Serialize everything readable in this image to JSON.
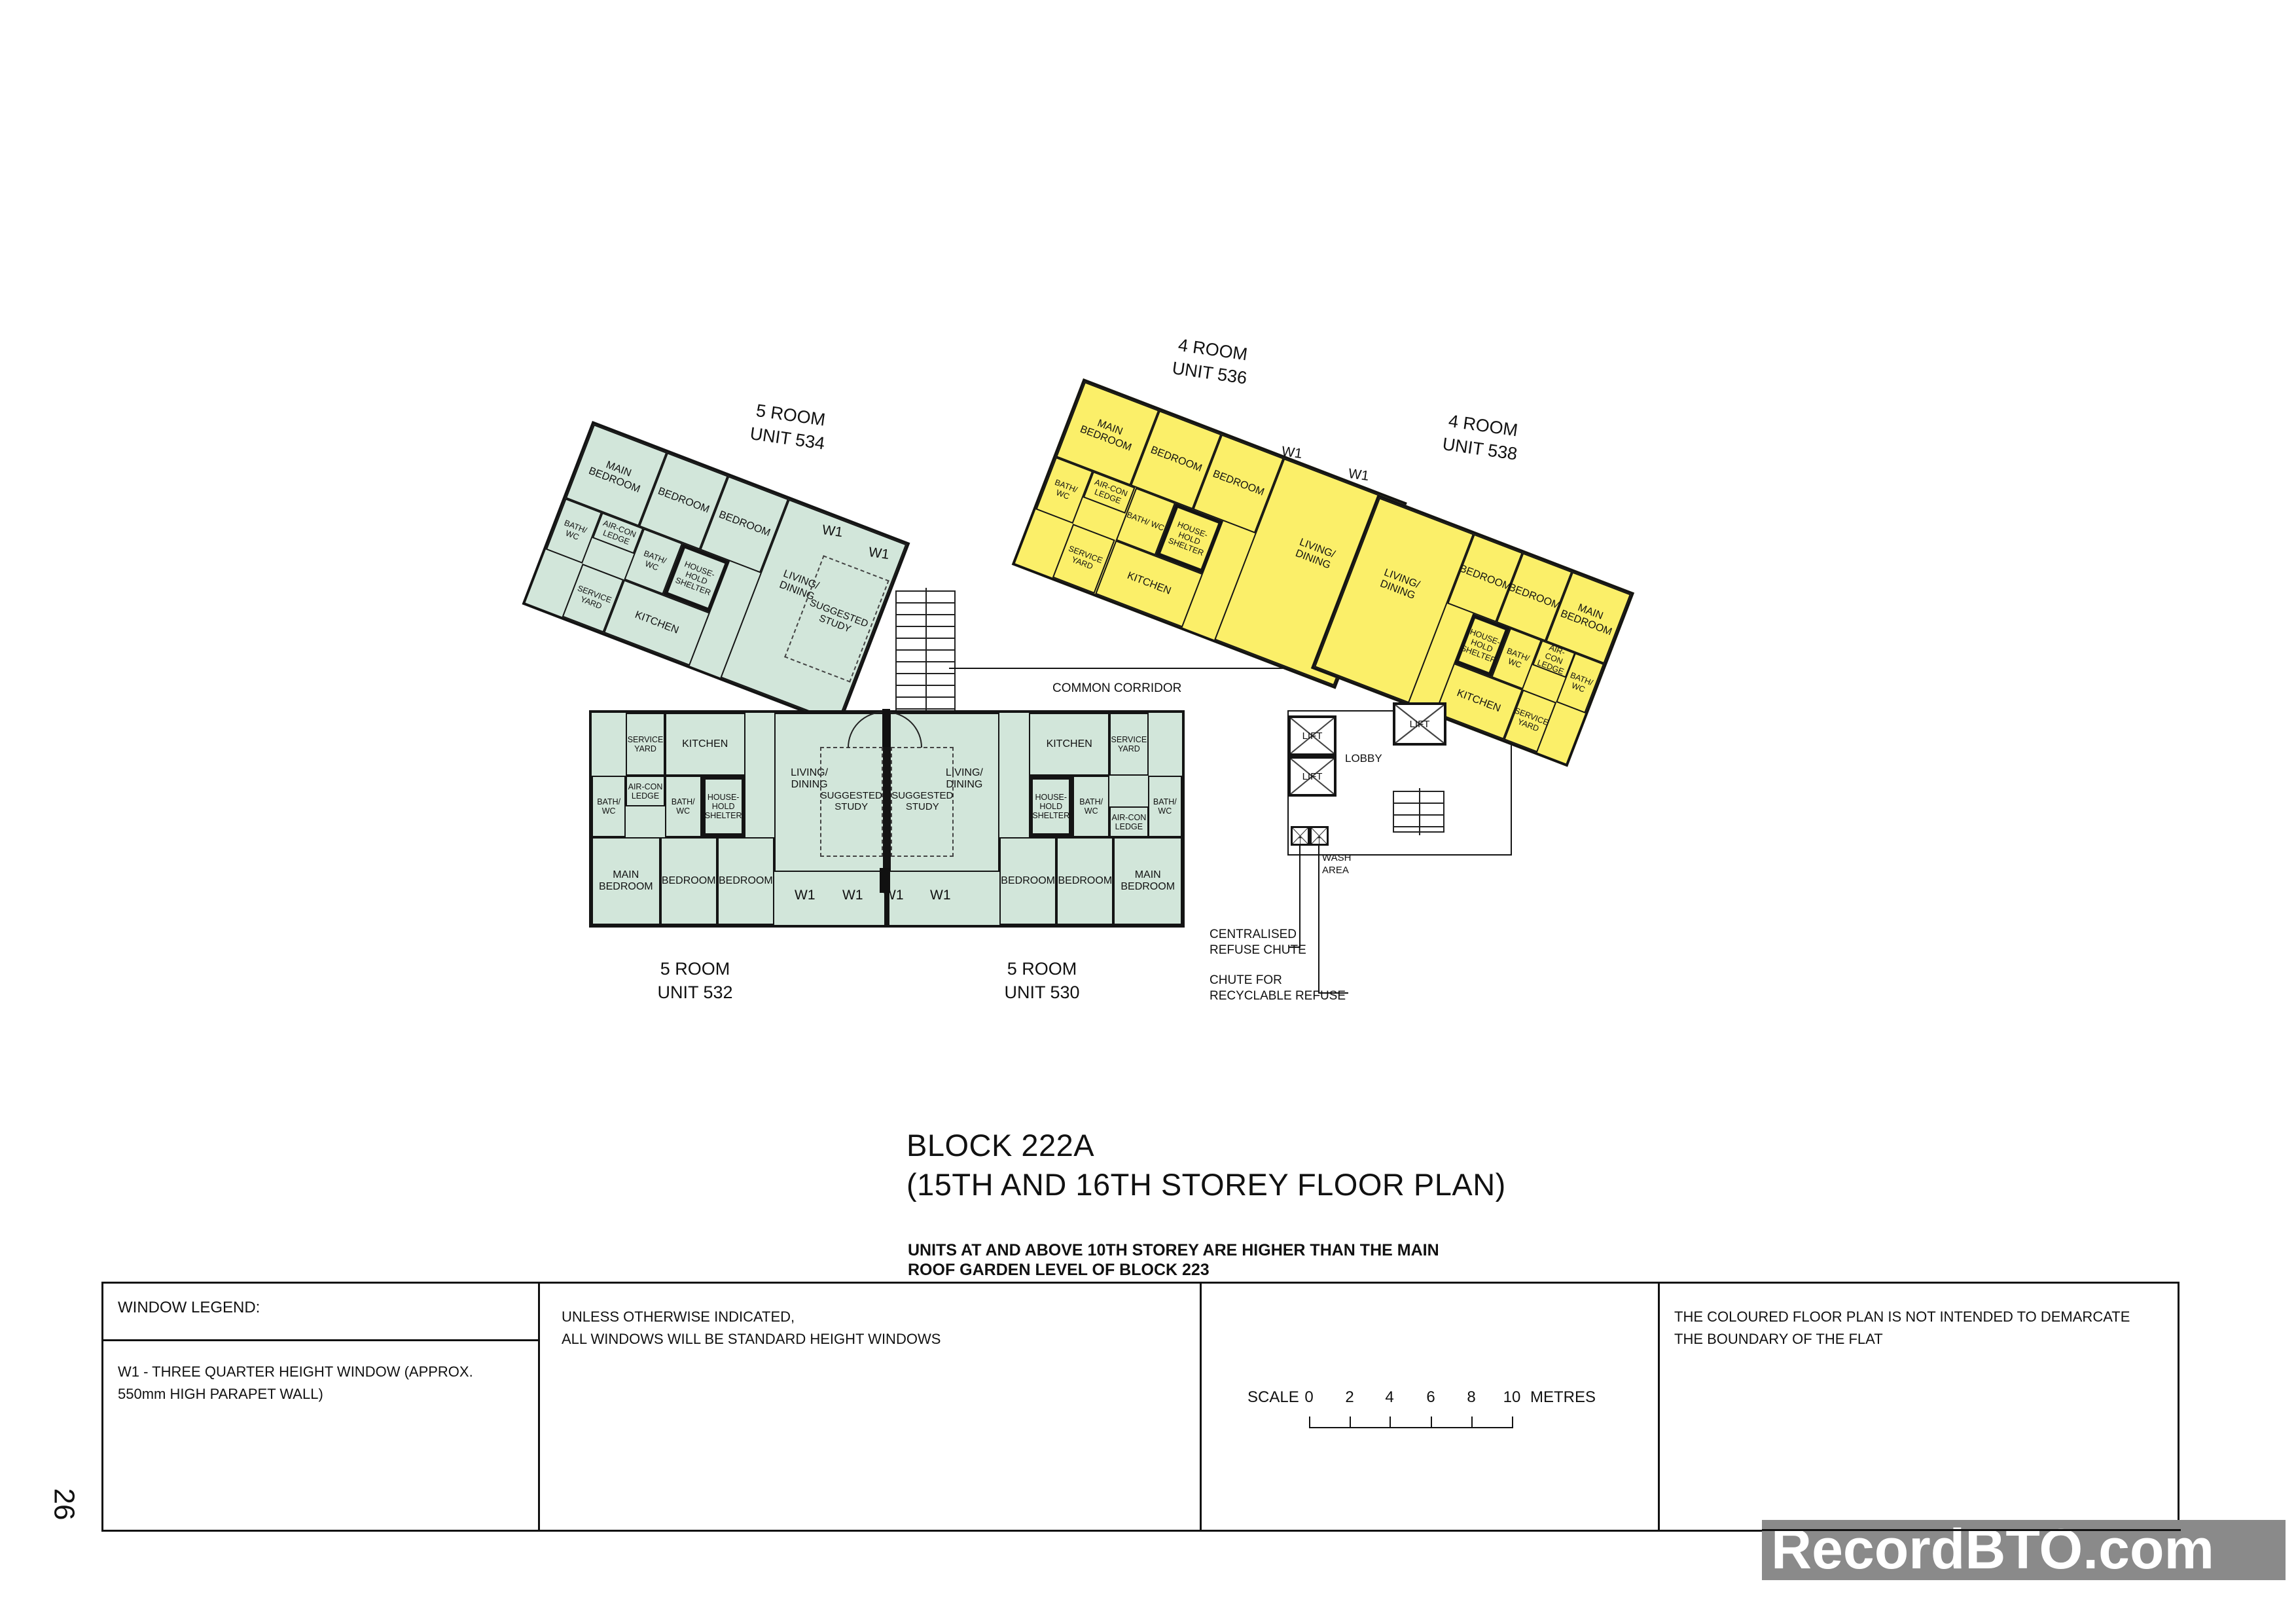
{
  "page_number": "26",
  "watermark": "RecordBTO.com",
  "colors": {
    "five_room_fill": "#d2e6da",
    "four_room_fill": "#fbef69",
    "wall": "#141414",
    "watermark_bg": "#8a8a8a"
  },
  "title": {
    "block": "BLOCK 222A",
    "storey": "(15TH AND 16TH STOREY FLOOR PLAN)",
    "note_line1": "UNITS AT AND ABOVE 10TH STOREY ARE HIGHER THAN THE MAIN",
    "note_line2": "ROOF GARDEN LEVEL OF BLOCK 223"
  },
  "plan": {
    "common_corridor": "COMMON CORRIDOR",
    "lobby": "LOBBY",
    "lift": "LIFT",
    "wash_area": "WASH AREA",
    "w1": "W1",
    "centralised_line1": "CENTRALISED",
    "centralised_line2": "REFUSE CHUTE",
    "recyclable_line1": "CHUTE FOR",
    "recyclable_line2": "RECYCLABLE REFUSE"
  },
  "room_labels": {
    "main_bedroom": "MAIN BEDROOM",
    "bedroom": "BEDROOM",
    "bath_wc": "BATH/ WC",
    "aircon_ledge": "AIR-CON LEDGE",
    "household_shelter": "HOUSE- HOLD SHELTER",
    "service_yard": "SERVICE YARD",
    "kitchen": "KITCHEN",
    "living_dining": "LIVING/ DINING",
    "suggested_study": "SUGGESTED STUDY"
  },
  "units": {
    "u534": {
      "type": "5 ROOM",
      "no": "UNIT 534"
    },
    "u536": {
      "type": "4 ROOM",
      "no": "UNIT 536"
    },
    "u538": {
      "type": "4 ROOM",
      "no": "UNIT 538"
    },
    "u532": {
      "type": "5 ROOM",
      "no": "UNIT 532"
    },
    "u530": {
      "type": "5 ROOM",
      "no": "UNIT 530"
    }
  },
  "legend": {
    "window_legend_title": "WINDOW LEGEND:",
    "window_legend_body": "W1 -  THREE QUARTER HEIGHT WINDOW (APPROX. 550mm HIGH PARAPET WALL)",
    "windows_note_line1": "UNLESS OTHERWISE INDICATED,",
    "windows_note_line2": "ALL WINDOWS WILL BE STANDARD HEIGHT WINDOWS",
    "coloured_note_line1": "THE COLOURED FLOOR PLAN IS NOT INTENDED TO DEMARCATE",
    "coloured_note_line2": "THE BOUNDARY OF THE FLAT",
    "scale": {
      "label": "SCALE",
      "ticks": [
        "0",
        "2",
        "4",
        "6",
        "8",
        "10"
      ],
      "unit": "METRES"
    }
  }
}
